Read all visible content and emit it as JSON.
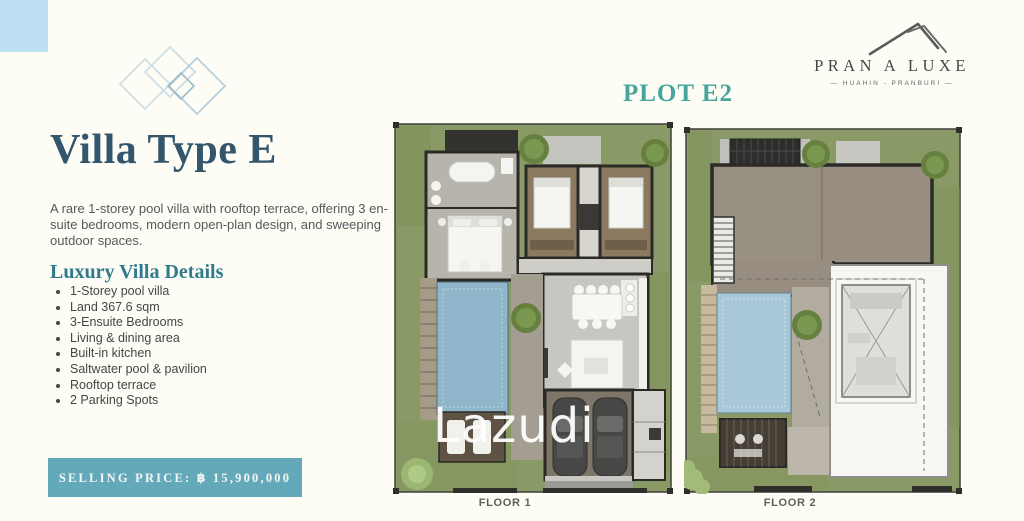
{
  "colors": {
    "corner_blue": "#BCDFF1",
    "title_blue": "#33566D",
    "heading_teal": "#2F7A8C",
    "plot_teal": "#47A59C",
    "banner_teal": "#64A9BA",
    "banner_text": "#F2F7F5",
    "body_text": "#57585A",
    "lawn_green": "#8A9A66",
    "pool_blue": "#8FB6CB",
    "pool2_blue": "#A9C8D7",
    "watermark_white": "#FFFFFF"
  },
  "left_panel": {
    "title": "Villa Type E",
    "description": "A rare 1-storey pool villa with rooftop terrace, offering 3 en-suite bedrooms, modern open-plan design, and sweeping outdoor spaces.",
    "details_heading": "Luxury Villa Details",
    "details": [
      "1-Storey pool villa",
      "Land 367.6 sqm",
      "3-Ensuite Bedrooms",
      "Living & dining area",
      "Built-in kitchen",
      "Saltwater pool & pavilion",
      "Rooftop terrace",
      "2 Parking Spots"
    ],
    "selling_price": "SELLING PRICE: ฿ 15,900,000"
  },
  "brand": {
    "name": "PRAN A LUXE",
    "tagline": "—  HUAHIN - PRANBURI  —"
  },
  "plans": {
    "plot_label": "PLOT E2",
    "floor1_label": "FLOOR 1",
    "floor2_label": "FLOOR 2"
  },
  "watermark": "Lazudi"
}
